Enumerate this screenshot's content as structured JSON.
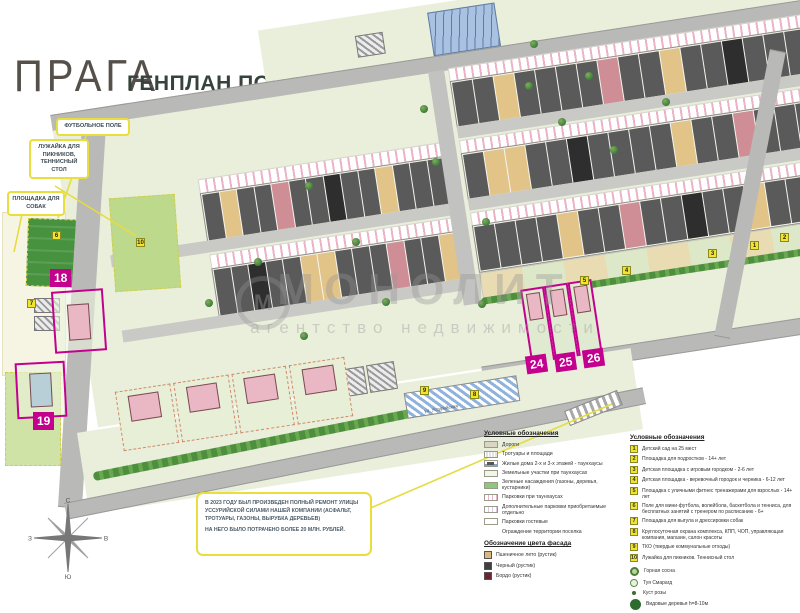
{
  "header": {
    "logo": "ПРАГА",
    "title": "ГЕНПЛАН ПОСЕЛКА"
  },
  "callouts": [
    {
      "id": "football",
      "text": "ФУТБОЛЬНОЕ ПОЛЕ",
      "x": 56,
      "y": 118,
      "w": 66
    },
    {
      "id": "picnic",
      "text": "ЛУЖАЙКА ДЛЯ ПИКНИКОВ, ТЕННИСНЫЙ СТОЛ",
      "x": 29,
      "y": 139,
      "w": 52
    },
    {
      "id": "dogs",
      "text": "ПЛОЩАДКА ДЛЯ СОБАК",
      "x": 7,
      "y": 191,
      "w": 50
    }
  ],
  "leader_lines": [
    [
      86,
      136,
      58,
      218
    ],
    [
      55,
      186,
      136,
      236
    ],
    [
      22,
      214,
      14,
      252
    ],
    [
      352,
      516,
      612,
      404
    ]
  ],
  "note": {
    "line1": "В 2023 ГОДУ БЫЛ ПРОИЗВЕДЕН ПОЛНЫЙ РЕМОНТ УЛИЦЫ УССУРИЙСКОЙ СИЛАМИ НАШЕЙ КОМПАНИИ (АСФАЛЬТ, ТРОТУАРЫ, ГАЗОНЫ, ВЫРУБКА ДЕРЕВЬЕВ)",
    "line2": "НА НЕГО БЫЛО ПОТРАЧЕНО БОЛЕЕ 20 МЛН. РУБЛЕЙ."
  },
  "street_label": "ул. Уссурийская",
  "watermark": {
    "title": "МОНОЛИТ",
    "subtitle": "агентство недвижимости",
    "emblem": "М"
  },
  "compass": {
    "n": "С",
    "e": "В",
    "s": "Ю",
    "w": "З"
  },
  "plot_labels": [
    {
      "n": "18",
      "x": 50,
      "y": 269,
      "r": 0
    },
    {
      "n": "19",
      "x": 33,
      "y": 412,
      "r": 0
    },
    {
      "n": "24",
      "x": 526,
      "y": 355,
      "r": -8
    },
    {
      "n": "25",
      "x": 555,
      "y": 353,
      "r": -8
    },
    {
      "n": "26",
      "x": 583,
      "y": 349,
      "r": -8
    }
  ],
  "map": {
    "palette": {
      "g": "#5a5a5a",
      "w": "#e2c488",
      "r": "#cf8e96",
      "b": "#2e2e2e"
    },
    "band_elements": [
      {
        "t": "green",
        "x": 160,
        "y": -68,
        "w": 540,
        "h": 52
      },
      {
        "t": "houses",
        "x": 505,
        "y": -118,
        "w": 165,
        "h": 42,
        "u": "ggwggbggw"
      },
      {
        "t": "bluebldg",
        "x": 330,
        "y": -60,
        "w": 66,
        "h": 42
      },
      {
        "t": "hatch",
        "x": 255,
        "y": -48,
        "w": 26,
        "h": 20
      },
      {
        "t": "road",
        "x": -58,
        "y": -16,
        "w": 762,
        "h": 15
      },
      {
        "t": "green",
        "x": -58,
        "y": 0,
        "w": 762,
        "h": 300
      },
      {
        "t": "parking",
        "x": 78,
        "y": 70,
        "w": 244,
        "h": 13
      },
      {
        "t": "houses",
        "x": 78,
        "y": 84,
        "w": 244,
        "h": 46,
        "u": "gwggrggbggwggg"
      },
      {
        "t": "street",
        "x": -20,
        "y": 132,
        "w": 342,
        "h": 12
      },
      {
        "t": "parking",
        "x": 78,
        "y": 146,
        "w": 244,
        "h": 13
      },
      {
        "t": "houses",
        "x": 78,
        "y": 160,
        "w": 244,
        "h": 46,
        "u": "ggbggwwgggrggw"
      },
      {
        "t": "street",
        "x": -20,
        "y": 208,
        "w": 342,
        "h": 12
      },
      {
        "t": "vroad",
        "x": 322,
        "y": -1,
        "w": 16,
        "h": 236
      },
      {
        "t": "parking",
        "x": 342,
        "y": -2,
        "w": 356,
        "h": 12
      },
      {
        "t": "houses",
        "x": 342,
        "y": 11,
        "w": 356,
        "h": 44,
        "u": "ggwggggrggwggbggg"
      },
      {
        "t": "street",
        "x": 342,
        "y": 57,
        "w": 356,
        "h": 12
      },
      {
        "t": "parking",
        "x": 342,
        "y": 71,
        "w": 356,
        "h": 12
      },
      {
        "t": "houses",
        "x": 342,
        "y": 84,
        "w": 356,
        "h": 44,
        "u": "gwwggbggggwggrggg"
      },
      {
        "t": "street",
        "x": 342,
        "y": 130,
        "w": 356,
        "h": 12
      },
      {
        "t": "parking",
        "x": 342,
        "y": 144,
        "w": 356,
        "h": 12
      },
      {
        "t": "houses",
        "x": 342,
        "y": 157,
        "w": 356,
        "h": 44,
        "u": "ggggwggrggbggwggg"
      },
      {
        "t": "amenity",
        "x": 342,
        "y": 205,
        "w": 356,
        "h": 24
      },
      {
        "t": "hedge",
        "x": 340,
        "y": 230,
        "w": 368,
        "h": 7
      },
      {
        "t": "road",
        "x": 330,
        "y": 298,
        "w": 390,
        "h": 15
      },
      {
        "t": "plotv",
        "x": 380,
        "y": 228,
        "w": 20,
        "h": 78
      },
      {
        "t": "plotv",
        "x": 404,
        "y": 228,
        "w": 20,
        "h": 78
      },
      {
        "t": "plotv",
        "x": 428,
        "y": 228,
        "w": 20,
        "h": 78
      }
    ],
    "markers": [
      {
        "n": "1",
        "x": 750,
        "y": 241
      },
      {
        "n": "2",
        "x": 780,
        "y": 233
      },
      {
        "n": "3",
        "x": 708,
        "y": 249
      },
      {
        "n": "4",
        "x": 622,
        "y": 266
      },
      {
        "n": "5",
        "x": 580,
        "y": 276
      },
      {
        "n": "6",
        "x": 52,
        "y": 231
      },
      {
        "n": "7",
        "x": 27,
        "y": 299
      },
      {
        "n": "8",
        "x": 470,
        "y": 390
      },
      {
        "n": "9",
        "x": 420,
        "y": 386
      },
      {
        "n": "10",
        "x": 136,
        "y": 238
      }
    ],
    "trees": [
      [
        420,
        105
      ],
      [
        432,
        158
      ],
      [
        525,
        82
      ],
      [
        558,
        118
      ],
      [
        610,
        146
      ],
      [
        662,
        98
      ],
      [
        305,
        182
      ],
      [
        352,
        238
      ],
      [
        482,
        218
      ],
      [
        254,
        258
      ],
      [
        205,
        299
      ],
      [
        382,
        298
      ],
      [
        300,
        332
      ],
      [
        478,
        300
      ],
      [
        530,
        40
      ],
      [
        585,
        72
      ]
    ]
  },
  "legend_left": {
    "title": "Условные обозначения",
    "items": [
      {
        "swatch": "road",
        "label": "Дороги"
      },
      {
        "swatch": "sidewalk",
        "label": "Тротуары и площади"
      },
      {
        "swatch": "townhouse",
        "label": "Жилые дома 2-х и 3-х этажей - таунхаусы"
      },
      {
        "swatch": "plot",
        "label": "Земельные участки при таунхаусах"
      },
      {
        "swatch": "green",
        "label": "Зеленые насаждения (газоны, деревья, кустарники)"
      },
      {
        "swatch": "parking",
        "label": "Парковки при таунхаусах"
      },
      {
        "swatch": "parking-extra",
        "label": "Дополнительные парковки приобретаемые отдельно"
      },
      {
        "swatch": "parking-guest",
        "label": "Парковки гостевые"
      }
    ],
    "fence_note": "Ограждение территории поселка",
    "facade": {
      "title": "Обозначение цвета фасада",
      "items": [
        {
          "label": "Пшеничное лето (рустик)",
          "color": "#d8b97a"
        },
        {
          "label": "Черный (рустик)",
          "color": "#3f3f3f"
        },
        {
          "label": "Бордо (рустик)",
          "color": "#6e2430"
        }
      ]
    }
  },
  "legend_right": {
    "title": "Условные обозначения",
    "items": [
      {
        "n": "1",
        "text": "Детский сад на 25 мест"
      },
      {
        "n": "2",
        "text": "Площадка для подростков - 14+ лет"
      },
      {
        "n": "3",
        "text": "Детская площадка с игровым городком - 2-6 лет"
      },
      {
        "n": "4",
        "text": "Детская площадка - веревочный городок и черника - 6-12 лет"
      },
      {
        "n": "5",
        "text": "Площадка с уличными фитнес тренажерами для взрослых - 14+ лет"
      },
      {
        "n": "6",
        "text": "Поле для мини-футбола, волейбола, баскетбола и тенниса, для бесплатных занятий с тренером по расписанию - 6+"
      },
      {
        "n": "7",
        "text": "Площадка для выгула и дрессировки собак"
      },
      {
        "n": "8",
        "text": "Круглосуточная охрана комплекса, КПП, ЧОП, управляющая компания, магазин, салон красоты"
      },
      {
        "n": "9",
        "text": "ТКО (твердые коммунальные отходы)"
      },
      {
        "n": "10",
        "text": "Лужайка для пикников. Теннисный стол"
      }
    ],
    "plants": [
      {
        "icon": "pine",
        "label": "Горная сосна"
      },
      {
        "icon": "thuja",
        "label": "Туя Смарагд"
      },
      {
        "icon": "rose",
        "label": "Куст розы"
      },
      {
        "icon": "tall",
        "label": "Видовые деревья h=8-10м"
      }
    ]
  }
}
